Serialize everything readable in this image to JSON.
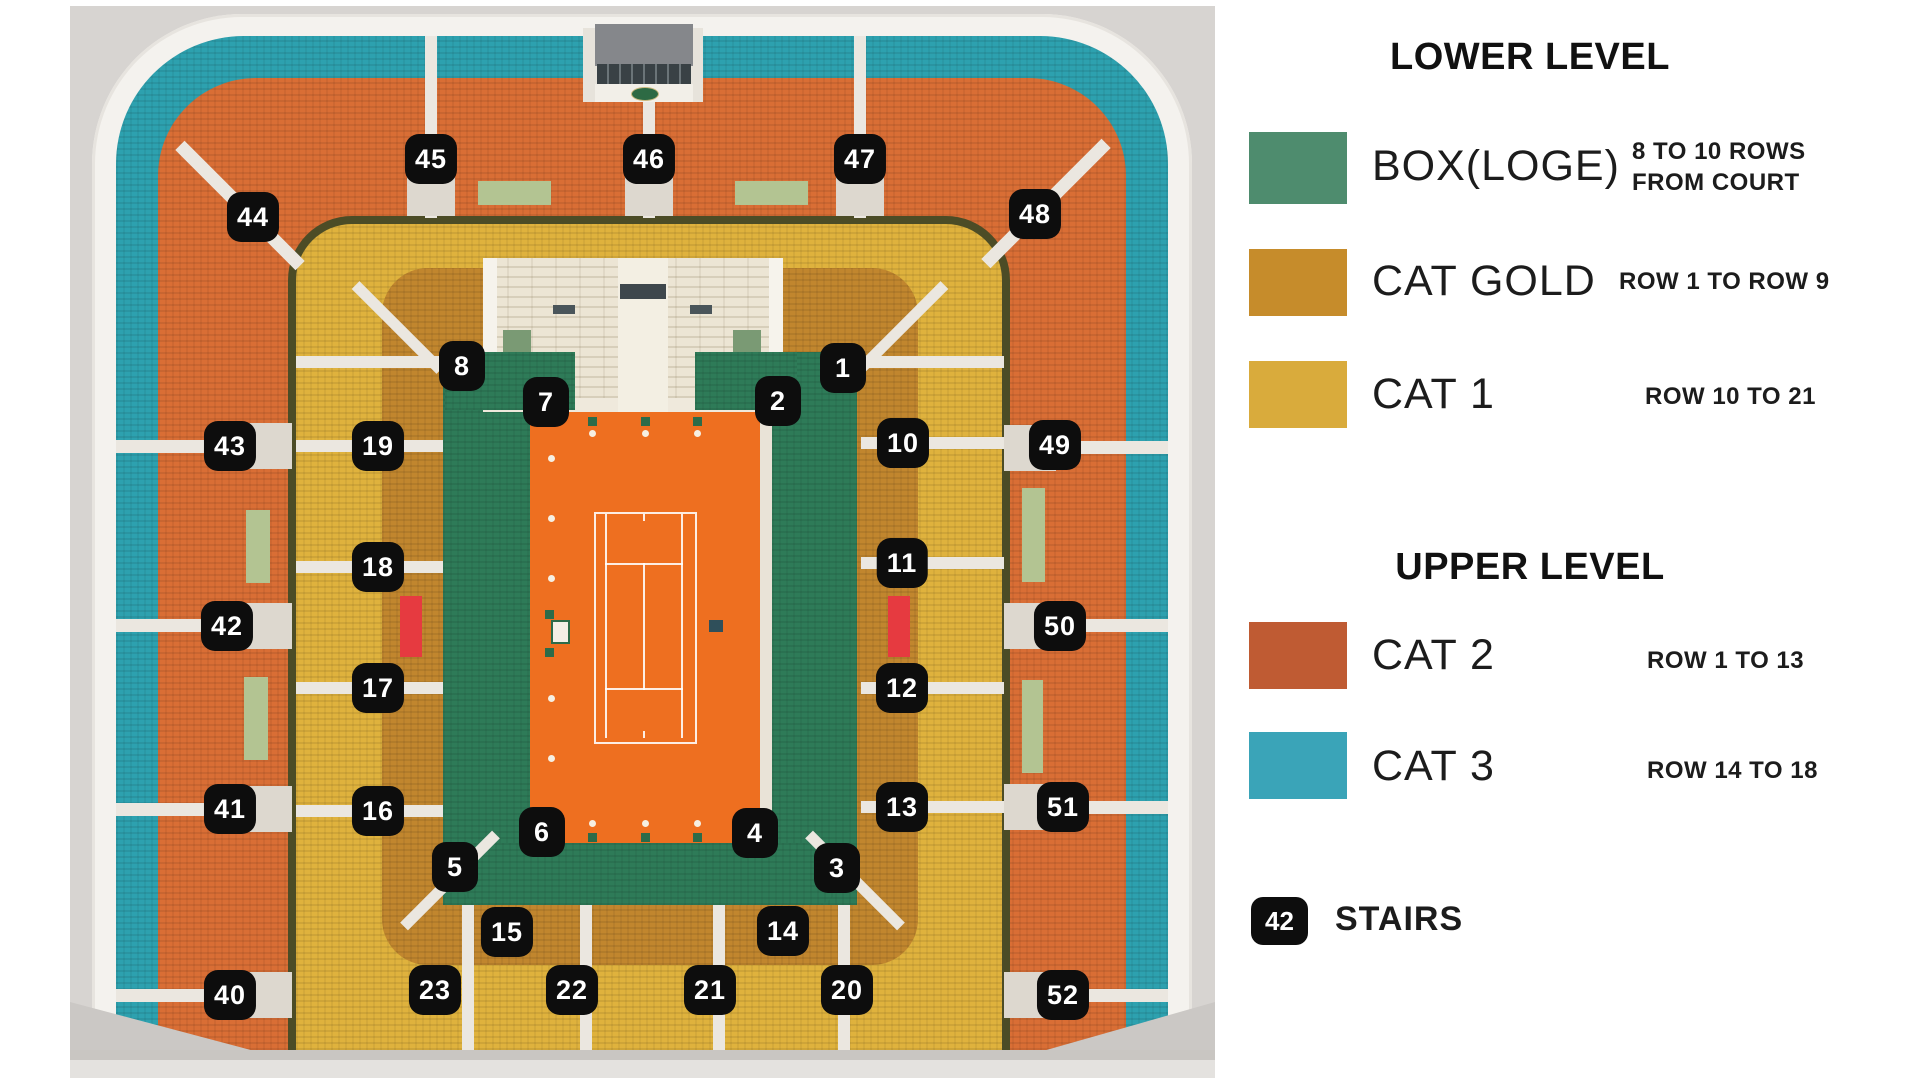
{
  "map": {
    "colors": {
      "box": "#2e7b58",
      "cat_gold": "#c1862e",
      "cat1": "#dfb23d",
      "cat2": "#d96e35",
      "cat3": "#2da1af",
      "clay": "#ee6f20",
      "sage": "#b3c492",
      "red_block": "#e63a40"
    },
    "badges": [
      {
        "label": "45",
        "x": 431,
        "y": 159
      },
      {
        "label": "46",
        "x": 649,
        "y": 159
      },
      {
        "label": "47",
        "x": 860,
        "y": 159
      },
      {
        "label": "44",
        "x": 253,
        "y": 217
      },
      {
        "label": "48",
        "x": 1035,
        "y": 214
      },
      {
        "label": "8",
        "x": 462,
        "y": 366
      },
      {
        "label": "7",
        "x": 546,
        "y": 402
      },
      {
        "label": "2",
        "x": 778,
        "y": 401
      },
      {
        "label": "1",
        "x": 843,
        "y": 368
      },
      {
        "label": "19",
        "x": 378,
        "y": 446
      },
      {
        "label": "10",
        "x": 903,
        "y": 443
      },
      {
        "label": "43",
        "x": 230,
        "y": 446
      },
      {
        "label": "49",
        "x": 1055,
        "y": 445
      },
      {
        "label": "18",
        "x": 378,
        "y": 567
      },
      {
        "label": "11",
        "x": 902,
        "y": 563
      },
      {
        "label": "42",
        "x": 227,
        "y": 626
      },
      {
        "label": "50",
        "x": 1060,
        "y": 626
      },
      {
        "label": "17",
        "x": 378,
        "y": 688
      },
      {
        "label": "12",
        "x": 902,
        "y": 688
      },
      {
        "label": "16",
        "x": 378,
        "y": 811
      },
      {
        "label": "13",
        "x": 902,
        "y": 807
      },
      {
        "label": "41",
        "x": 230,
        "y": 809
      },
      {
        "label": "51",
        "x": 1063,
        "y": 807
      },
      {
        "label": "6",
        "x": 542,
        "y": 832
      },
      {
        "label": "4",
        "x": 755,
        "y": 833
      },
      {
        "label": "5",
        "x": 455,
        "y": 867
      },
      {
        "label": "3",
        "x": 837,
        "y": 868
      },
      {
        "label": "15",
        "x": 507,
        "y": 932
      },
      {
        "label": "14",
        "x": 783,
        "y": 931
      },
      {
        "label": "40",
        "x": 230,
        "y": 995
      },
      {
        "label": "23",
        "x": 435,
        "y": 990
      },
      {
        "label": "22",
        "x": 572,
        "y": 990
      },
      {
        "label": "21",
        "x": 710,
        "y": 990
      },
      {
        "label": "20",
        "x": 847,
        "y": 990
      },
      {
        "label": "52",
        "x": 1063,
        "y": 995
      }
    ]
  },
  "legend": {
    "lower_title": "LOWER LEVEL",
    "upper_title": "UPPER LEVEL",
    "rows": [
      {
        "color": "#4e8c6e",
        "label": "BOX(LOGE)",
        "desc1": "8 TO 10 ROWS",
        "desc2": "FROM COURT"
      },
      {
        "color": "#c68c2b",
        "label": "CAT GOLD",
        "desc1": "ROW 1 TO ROW 9",
        "desc2": ""
      },
      {
        "color": "#d9ab3c",
        "label": "CAT 1",
        "desc1": "ROW 10 TO 21",
        "desc2": ""
      },
      {
        "color": "#bf5b33",
        "label": "CAT 2",
        "desc1": "ROW 1 TO 13",
        "desc2": ""
      },
      {
        "color": "#3aa4b8",
        "label": "CAT 3",
        "desc1": "ROW 14 TO 18",
        "desc2": ""
      }
    ],
    "stairs": {
      "badge": "42",
      "label": "STAIRS"
    }
  }
}
